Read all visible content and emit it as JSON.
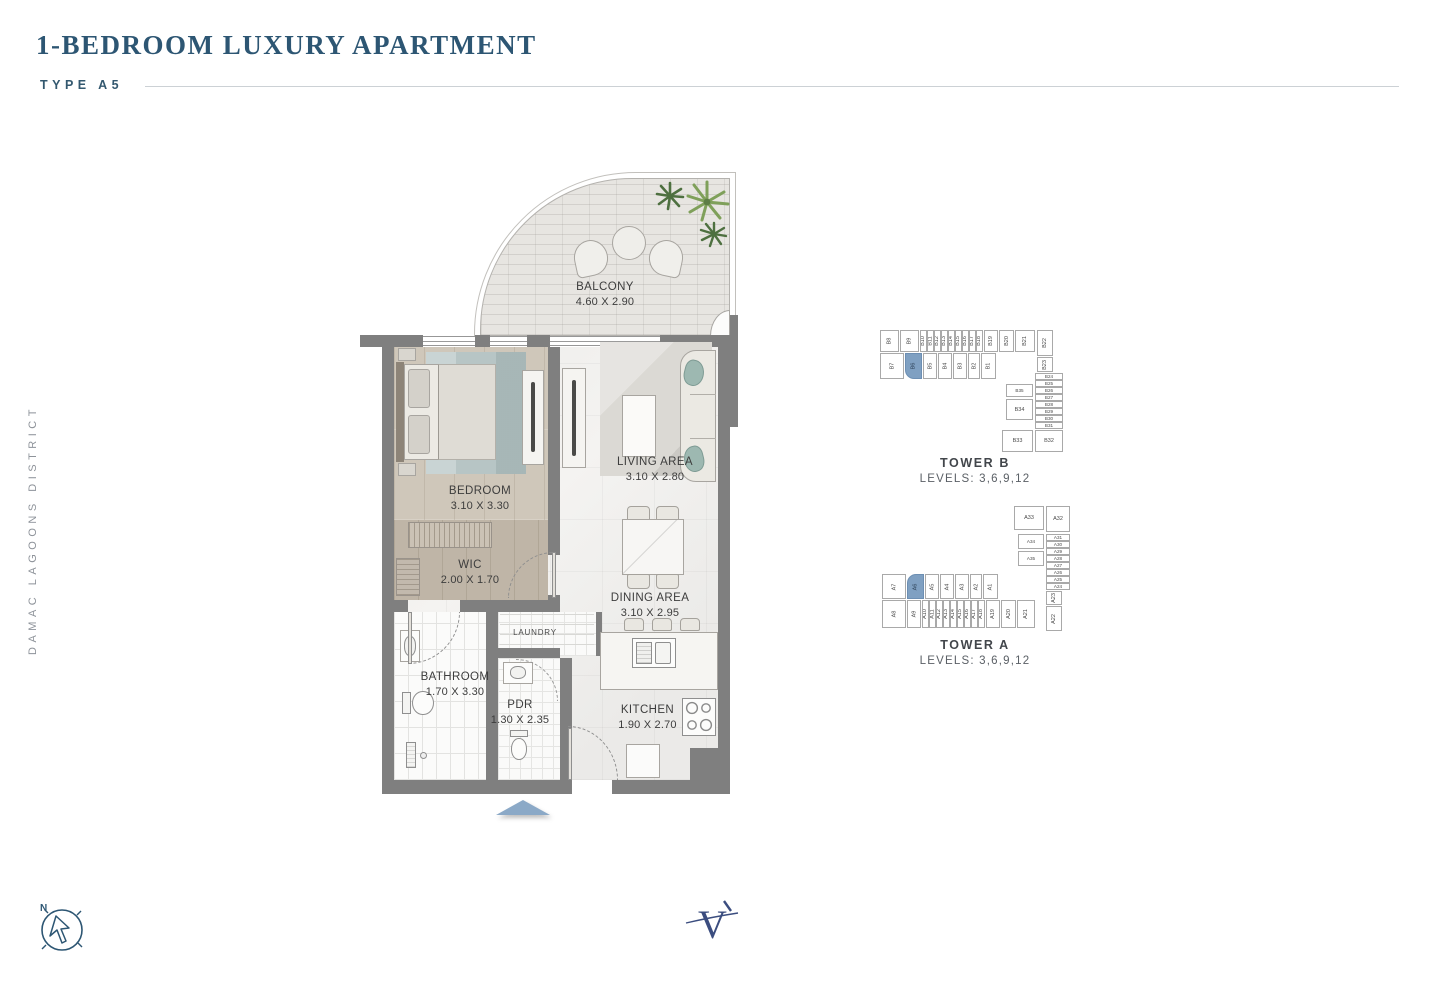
{
  "header": {
    "title": "1-BEDROOM LUXURY APARTMENT",
    "type_label": "TYPE A5"
  },
  "side_label": "DAMAC LAGOONS DISTRICT",
  "floorplan": {
    "rooms": [
      {
        "name": "BALCONY",
        "dims": "4.60 X 2.90"
      },
      {
        "name": "BEDROOM",
        "dims": "3.10 X 3.30"
      },
      {
        "name": "LIVING AREA",
        "dims": "3.10 X 2.80"
      },
      {
        "name": "WIC",
        "dims": "2.00 X 1.70"
      },
      {
        "name": "DINING AREA",
        "dims": "3.10 X 2.95"
      },
      {
        "name": "LAUNDRY",
        "dims": ""
      },
      {
        "name": "BATHROOM",
        "dims": "1.70 X 3.30"
      },
      {
        "name": "PDR",
        "dims": "1.30 X 2.35"
      },
      {
        "name": "KITCHEN",
        "dims": "1.90 X 2.70"
      }
    ]
  },
  "keyplans": [
    {
      "name": "TOWER B",
      "levels": "LEVELS: 3,6,9,12",
      "highlighted_unit": "B6",
      "cells": [
        {
          "label": "B8",
          "x": 0,
          "y": 0,
          "w": 19,
          "h": 22,
          "rot": 1
        },
        {
          "label": "B9",
          "x": 20,
          "y": 0,
          "w": 19,
          "h": 22,
          "rot": 1
        },
        {
          "label": "B10",
          "x": 40,
          "y": 0,
          "w": 6.5,
          "h": 22,
          "rot": 1
        },
        {
          "label": "B11",
          "x": 47,
          "y": 0,
          "w": 6.5,
          "h": 22,
          "rot": 1
        },
        {
          "label": "B12",
          "x": 54,
          "y": 0,
          "w": 6.5,
          "h": 22,
          "rot": 1
        },
        {
          "label": "B13",
          "x": 61,
          "y": 0,
          "w": 6.5,
          "h": 22,
          "rot": 1
        },
        {
          "label": "B14",
          "x": 68,
          "y": 0,
          "w": 6.5,
          "h": 22,
          "rot": 1
        },
        {
          "label": "B15",
          "x": 75,
          "y": 0,
          "w": 6.5,
          "h": 22,
          "rot": 1
        },
        {
          "label": "B16",
          "x": 82,
          "y": 0,
          "w": 6.5,
          "h": 22,
          "rot": 1
        },
        {
          "label": "B17",
          "x": 89,
          "y": 0,
          "w": 6.5,
          "h": 22,
          "rot": 1
        },
        {
          "label": "B18",
          "x": 96,
          "y": 0,
          "w": 6.5,
          "h": 22,
          "rot": 1
        },
        {
          "label": "B19",
          "x": 104,
          "y": 0,
          "w": 14,
          "h": 22,
          "rot": 1
        },
        {
          "label": "B20",
          "x": 119,
          "y": 0,
          "w": 15,
          "h": 22,
          "rot": 1
        },
        {
          "label": "B21",
          "x": 135,
          "y": 0,
          "w": 20,
          "h": 22,
          "rot": 1
        },
        {
          "label": "B22",
          "x": 157,
          "y": 0,
          "w": 16,
          "h": 26,
          "rot": 1
        },
        {
          "label": "B7",
          "x": 0,
          "y": 23,
          "w": 24,
          "h": 26,
          "rot": 1
        },
        {
          "label": "B6",
          "x": 25,
          "y": 23,
          "w": 17,
          "h": 26,
          "rot": 1,
          "hl": 1,
          "r": "0 0 0 9px"
        },
        {
          "label": "B5",
          "x": 43,
          "y": 23,
          "w": 14,
          "h": 26,
          "rot": 1
        },
        {
          "label": "B4",
          "x": 58,
          "y": 23,
          "w": 14,
          "h": 26,
          "rot": 1
        },
        {
          "label": "B3",
          "x": 73,
          "y": 23,
          "w": 14,
          "h": 26,
          "rot": 1
        },
        {
          "label": "B2",
          "x": 88,
          "y": 23,
          "w": 12,
          "h": 26,
          "rot": 1
        },
        {
          "label": "B1",
          "x": 101,
          "y": 23,
          "w": 15,
          "h": 26,
          "rot": 1
        },
        {
          "label": "B23",
          "x": 157,
          "y": 27,
          "w": 16,
          "h": 15,
          "rot": 1
        },
        {
          "label": "B24",
          "x": 155,
          "y": 43,
          "w": 28,
          "h": 7,
          "tiny": 1
        },
        {
          "label": "B25",
          "x": 155,
          "y": 50,
          "w": 28,
          "h": 7,
          "tiny": 1
        },
        {
          "label": "B26",
          "x": 155,
          "y": 57,
          "w": 28,
          "h": 7,
          "tiny": 1
        },
        {
          "label": "B27",
          "x": 155,
          "y": 64,
          "w": 28,
          "h": 7,
          "tiny": 1
        },
        {
          "label": "B28",
          "x": 155,
          "y": 71,
          "w": 28,
          "h": 7,
          "tiny": 1
        },
        {
          "label": "B29",
          "x": 155,
          "y": 78,
          "w": 28,
          "h": 7,
          "tiny": 1
        },
        {
          "label": "B30",
          "x": 155,
          "y": 85,
          "w": 28,
          "h": 7,
          "tiny": 1
        },
        {
          "label": "B31",
          "x": 155,
          "y": 92,
          "w": 28,
          "h": 7,
          "tiny": 1
        },
        {
          "label": "B32",
          "x": 155,
          "y": 100,
          "w": 28,
          "h": 22
        },
        {
          "label": "B35",
          "x": 126,
          "y": 54,
          "w": 27,
          "h": 13,
          "tiny": 1
        },
        {
          "label": "B34",
          "x": 126,
          "y": 69,
          "w": 27,
          "h": 21
        },
        {
          "label": "B33",
          "x": 122,
          "y": 100,
          "w": 31,
          "h": 22
        }
      ]
    },
    {
      "name": "TOWER A",
      "levels": "LEVELS: 3,6,9,12",
      "highlighted_unit": "A6",
      "cells": [
        {
          "label": "A33",
          "x": 134,
          "y": 0,
          "w": 30,
          "h": 24
        },
        {
          "label": "A32",
          "x": 166,
          "y": 0,
          "w": 24,
          "h": 26
        },
        {
          "label": "A31",
          "x": 166,
          "y": 28,
          "w": 24,
          "h": 7,
          "tiny": 1
        },
        {
          "label": "A30",
          "x": 166,
          "y": 35,
          "w": 24,
          "h": 7,
          "tiny": 1
        },
        {
          "label": "A29",
          "x": 166,
          "y": 42,
          "w": 24,
          "h": 7,
          "tiny": 1
        },
        {
          "label": "A28",
          "x": 166,
          "y": 49,
          "w": 24,
          "h": 7,
          "tiny": 1
        },
        {
          "label": "A27",
          "x": 166,
          "y": 56,
          "w": 24,
          "h": 7,
          "tiny": 1
        },
        {
          "label": "A26",
          "x": 166,
          "y": 63,
          "w": 24,
          "h": 7,
          "tiny": 1
        },
        {
          "label": "A25",
          "x": 166,
          "y": 70,
          "w": 24,
          "h": 7,
          "tiny": 1
        },
        {
          "label": "A24",
          "x": 166,
          "y": 77,
          "w": 24,
          "h": 7,
          "tiny": 1
        },
        {
          "label": "A34",
          "x": 138,
          "y": 28,
          "w": 26,
          "h": 15,
          "tiny": 1
        },
        {
          "label": "A35",
          "x": 138,
          "y": 45,
          "w": 26,
          "h": 15,
          "tiny": 1
        },
        {
          "label": "A23",
          "x": 166,
          "y": 85,
          "w": 16,
          "h": 14,
          "rot": 1
        },
        {
          "label": "A7",
          "x": 2,
          "y": 68,
          "w": 24,
          "h": 25,
          "rot": 1
        },
        {
          "label": "A6",
          "x": 27,
          "y": 68,
          "w": 17,
          "h": 25,
          "rot": 1,
          "hl": 1,
          "r": "9px 0 0 0"
        },
        {
          "label": "A5",
          "x": 45,
          "y": 68,
          "w": 14,
          "h": 25,
          "rot": 1
        },
        {
          "label": "A4",
          "x": 60,
          "y": 68,
          "w": 14,
          "h": 25,
          "rot": 1
        },
        {
          "label": "A3",
          "x": 75,
          "y": 68,
          "w": 14,
          "h": 25,
          "rot": 1
        },
        {
          "label": "A2",
          "x": 90,
          "y": 68,
          "w": 12,
          "h": 25,
          "rot": 1
        },
        {
          "label": "A1",
          "x": 103,
          "y": 68,
          "w": 15,
          "h": 25,
          "rot": 1
        },
        {
          "label": "A8",
          "x": 2,
          "y": 94,
          "w": 24,
          "h": 28,
          "rot": 1
        },
        {
          "label": "A9",
          "x": 27,
          "y": 94,
          "w": 14,
          "h": 28,
          "rot": 1
        },
        {
          "label": "A10",
          "x": 42,
          "y": 94,
          "w": 6.5,
          "h": 28,
          "rot": 1
        },
        {
          "label": "A11",
          "x": 49,
          "y": 94,
          "w": 6.5,
          "h": 28,
          "rot": 1
        },
        {
          "label": "A12",
          "x": 56,
          "y": 94,
          "w": 6.5,
          "h": 28,
          "rot": 1
        },
        {
          "label": "A13",
          "x": 63,
          "y": 94,
          "w": 6.5,
          "h": 28,
          "rot": 1
        },
        {
          "label": "A14",
          "x": 70,
          "y": 94,
          "w": 6.5,
          "h": 28,
          "rot": 1
        },
        {
          "label": "A15",
          "x": 77,
          "y": 94,
          "w": 6.5,
          "h": 28,
          "rot": 1
        },
        {
          "label": "A16",
          "x": 84,
          "y": 94,
          "w": 6.5,
          "h": 28,
          "rot": 1
        },
        {
          "label": "A17",
          "x": 91,
          "y": 94,
          "w": 6.5,
          "h": 28,
          "rot": 1
        },
        {
          "label": "A18",
          "x": 98,
          "y": 94,
          "w": 6.5,
          "h": 28,
          "rot": 1
        },
        {
          "label": "A19",
          "x": 106,
          "y": 94,
          "w": 14,
          "h": 28,
          "rot": 1
        },
        {
          "label": "A20",
          "x": 121,
          "y": 94,
          "w": 15,
          "h": 28,
          "rot": 1
        },
        {
          "label": "A21",
          "x": 137,
          "y": 94,
          "w": 18,
          "h": 28,
          "rot": 1
        },
        {
          "label": "A22",
          "x": 166,
          "y": 100,
          "w": 16,
          "h": 25,
          "rot": 1
        }
      ]
    }
  ],
  "compass": {
    "north_label": "N"
  },
  "logo": {
    "letter": "V"
  },
  "colors": {
    "accent": "#2d5673",
    "unit_highlight": "#7fa0c2",
    "entrance_arrow": "#8ba9c7"
  }
}
